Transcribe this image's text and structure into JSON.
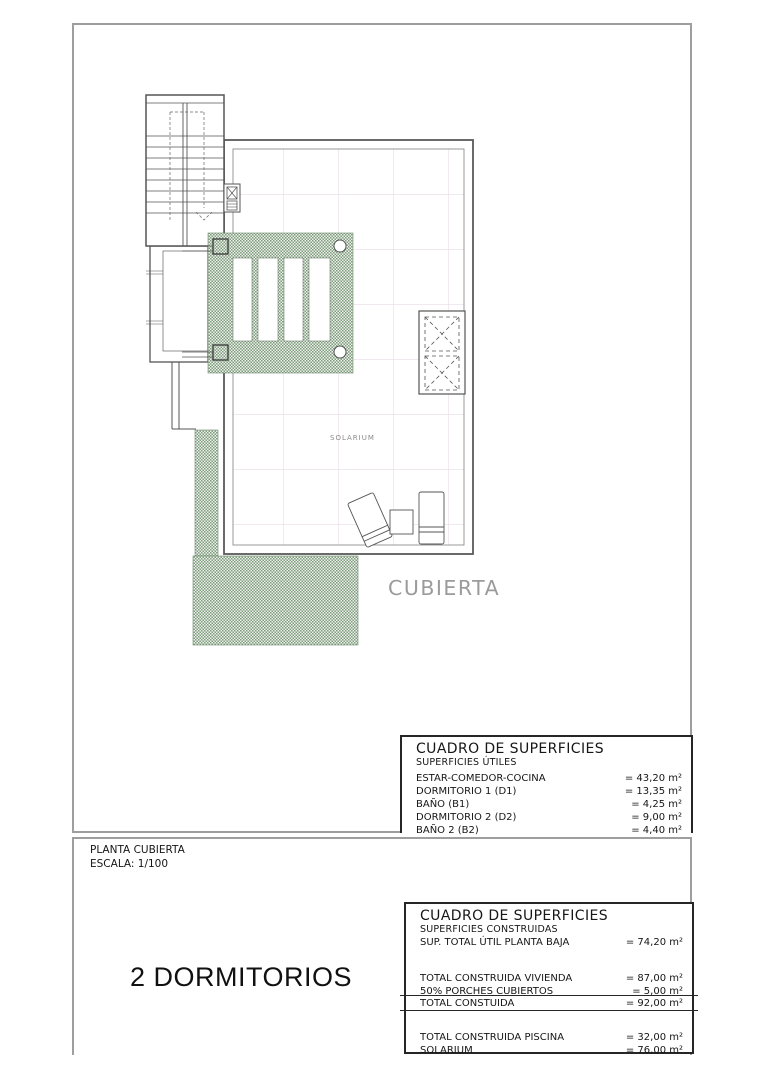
{
  "plan": {
    "solarium_label": "SOLARIUM",
    "cubierta_label": "CUBIERTA"
  },
  "title_block": {
    "plan_name": "PLANTA CUBIERTA",
    "scale": "ESCALA: 1/100",
    "variant": "2 DORMITORIOS"
  },
  "tables": {
    "utiles": {
      "title": "CUADRO DE SUPERFICIES",
      "subtitle": "SUPERFICIES ÚTILES",
      "rows": [
        {
          "label": "ESTAR-COMEDOR-COCINA",
          "value": "= 43,20 m²"
        },
        {
          "label": "DORMITORIO 1 (D1)",
          "value": "= 13,35 m²"
        },
        {
          "label": "BAÑO  (B1)",
          "value": "= 4,25 m²"
        },
        {
          "label": "DORMITORIO 2 (D2)",
          "value": "= 9,00 m²"
        },
        {
          "label": "BAÑO 2 (B2)",
          "value": "= 4,40 m²"
        }
      ]
    },
    "construidas": {
      "title": "CUADRO DE SUPERFICIES",
      "subtitle": "SUPERFICIES CONSTRUIDAS",
      "group1": [
        {
          "label": "SUP. TOTAL ÚTIL PLANTA BAJA",
          "value": "= 74,20 m²"
        }
      ],
      "group2": [
        {
          "label": "TOTAL CONSTRUIDA VIVIENDA",
          "value": "= 87,00 m²"
        },
        {
          "label": "50% PORCHES CUBIERTOS",
          "value": "= 5,00 m²"
        }
      ],
      "total_row": {
        "label": "TOTAL CONSTUIDA",
        "value": "= 92,00 m²"
      },
      "group3": [
        {
          "label": "TOTAL CONSTRUIDA PISCINA",
          "value": "= 32,00 m²"
        },
        {
          "label": "SOLARIUM",
          "value": "= 76,00 m²"
        }
      ]
    }
  },
  "colors": {
    "hatch_green": "#7e9b7e",
    "hatch_bg": "#edf2ea",
    "tile_grid": "#e7dce6",
    "line_dark": "#555555",
    "frame_gray": "#9e9e9e",
    "label_gray": "#9b9b9b"
  }
}
